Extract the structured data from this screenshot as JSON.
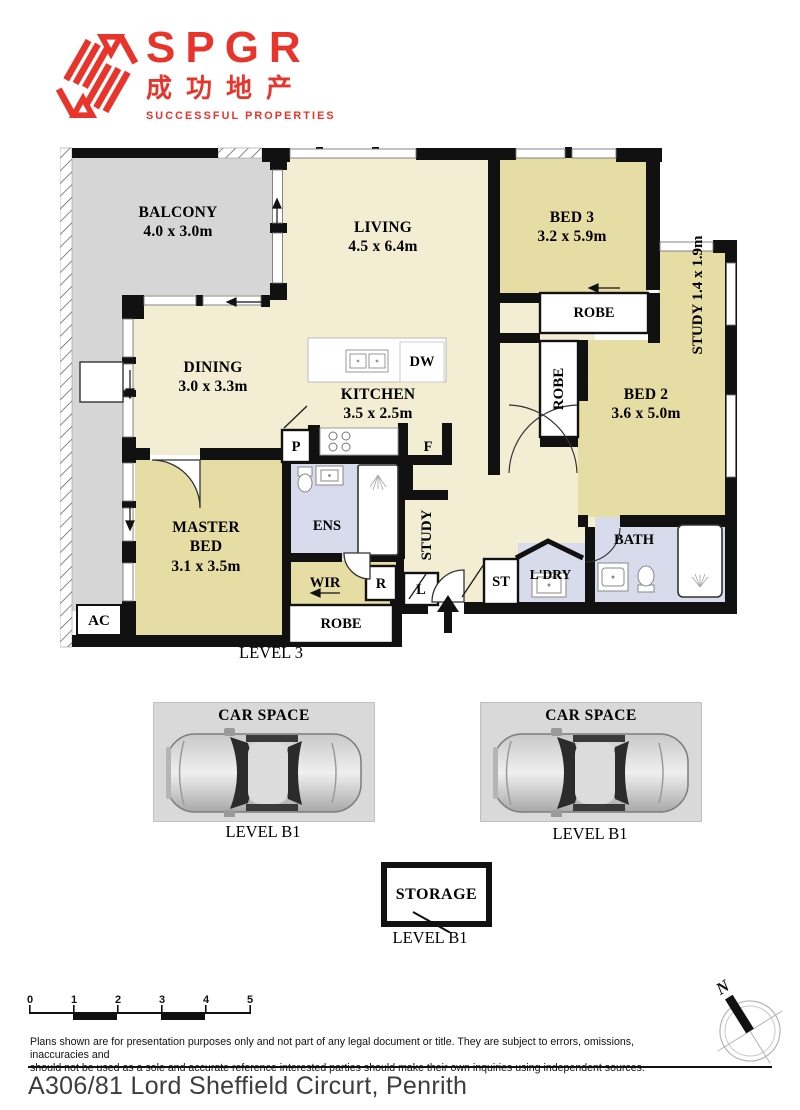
{
  "brand": {
    "name": "SPGR",
    "chinese": "成功地产",
    "tagline": "SUCCESSFUL PROPERTIES"
  },
  "plan": {
    "level_label": "LEVEL 3",
    "rooms": {
      "balcony": {
        "name": "BALCONY",
        "dims": "4.0 x 3.0m"
      },
      "living": {
        "name": "LIVING",
        "dims": "4.5 x 6.4m"
      },
      "bed3": {
        "name": "BED 3",
        "dims": "3.2 x 5.9m"
      },
      "study_right": {
        "name": "STUDY",
        "dims": "1.4 x 1.9m"
      },
      "bed2": {
        "name": "BED 2",
        "dims": "3.6 x 5.0m"
      },
      "dining": {
        "name": "DINING",
        "dims": "3.0 x 3.3m"
      },
      "kitchen": {
        "name": "KITCHEN",
        "dims": "3.5 x 2.5m"
      },
      "master": {
        "name": "MASTER BED",
        "dims": "3.1 x 3.5m"
      }
    },
    "labels": {
      "ens": "ENS",
      "wir": "WIR",
      "bath": "BATH",
      "laundry": "L'DRY",
      "study_hall": "STUDY",
      "robe_bed3": "ROBE",
      "robe_mid": "ROBE",
      "robe_master": "ROBE",
      "pantry": "P",
      "fridge": "F",
      "dishwasher": "DW",
      "r_box": "R",
      "l_box": "L",
      "st_box": "ST",
      "ac": "AC"
    }
  },
  "parking": {
    "space_label": "CAR SPACE",
    "level_label": "LEVEL B1"
  },
  "storage": {
    "label": "STORAGE",
    "level_label": "LEVEL B1"
  },
  "scalebar": {
    "ticks": [
      "0",
      "1",
      "2",
      "3",
      "4",
      "5"
    ]
  },
  "compass": {
    "north_label": "N"
  },
  "disclaimer": {
    "line1": "Plans shown are for presentation purposes only and not part of any legal document or title. They are subject to errors, omissions, inaccuracies and",
    "line2": "should not be used as a sole and accurate reference interested parties should make their own inquiries using independent sources."
  },
  "address": "A306/81 Lord Sheffield Circurt, Penrith",
  "colors": {
    "brand_red": "#e8342a",
    "room_cream": "#f3eed3",
    "room_khaki": "#e6dda4",
    "room_wet": "#d8dbeb",
    "outdoor_gray": "#d6d6d6",
    "wall": "#111111"
  }
}
